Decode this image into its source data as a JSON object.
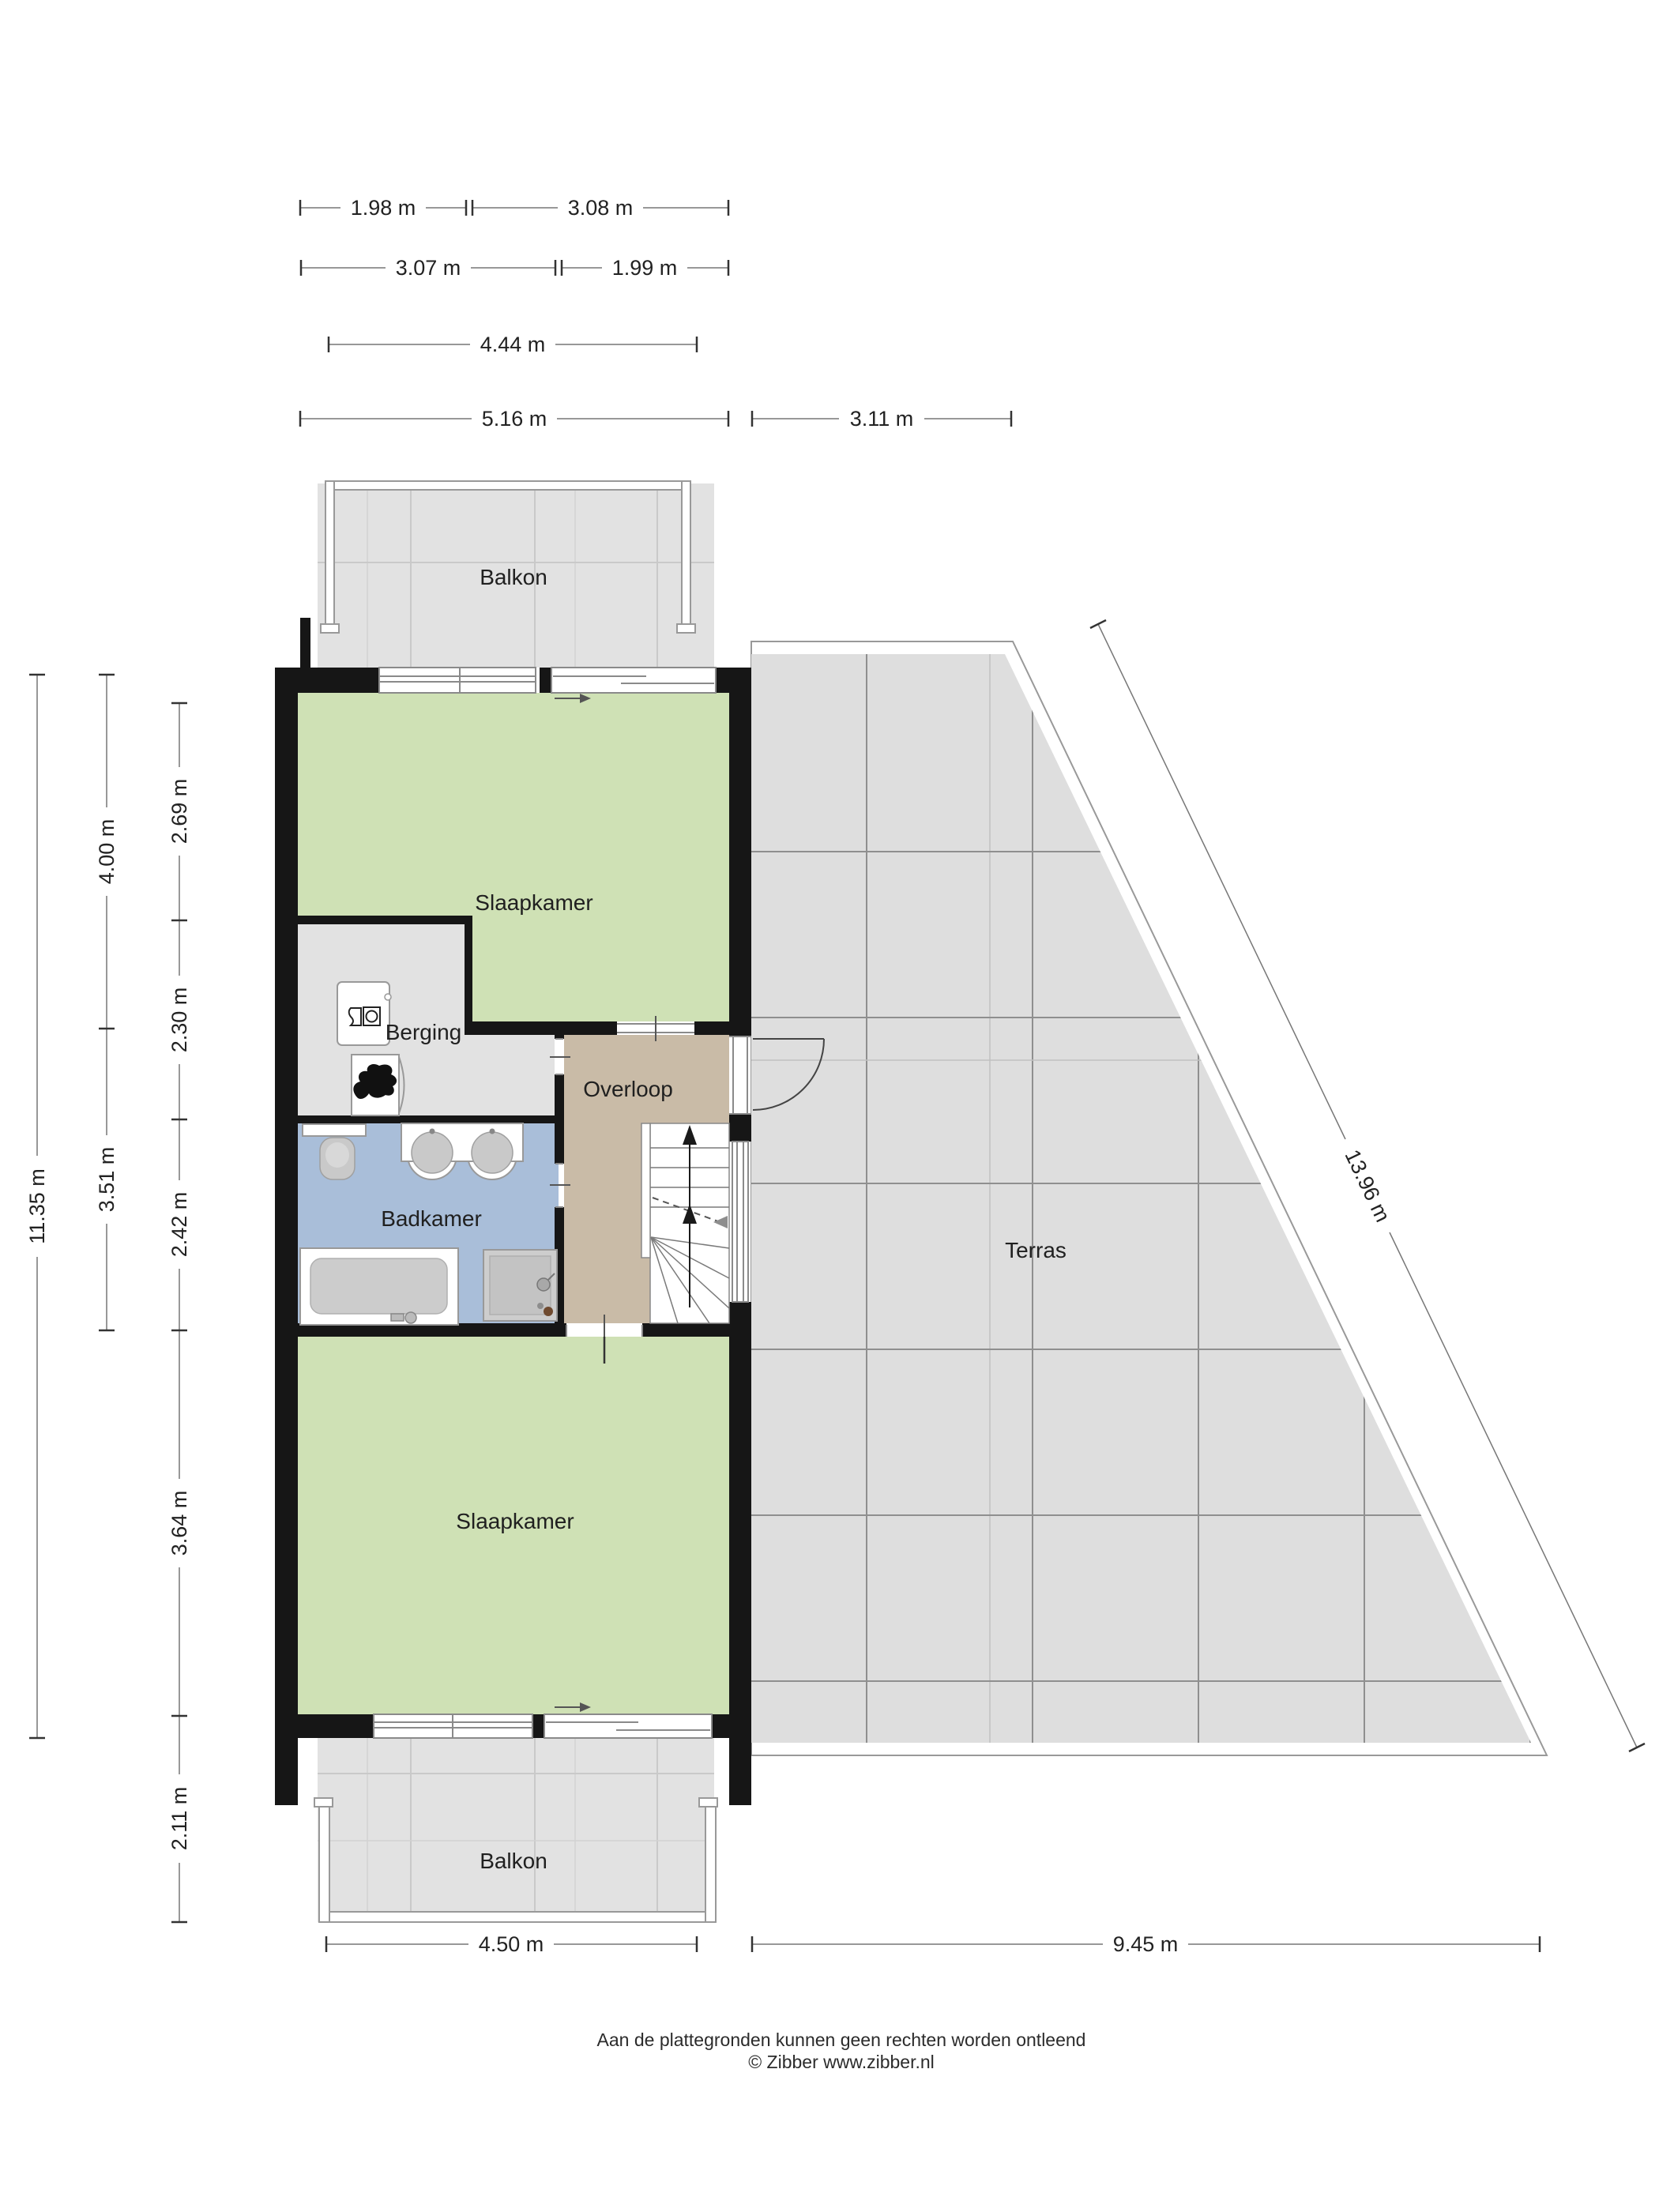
{
  "rooms": {
    "balkon_top": {
      "label": "Balkon"
    },
    "slaapkamer_top": {
      "label": "Slaapkamer"
    },
    "berging": {
      "label": "Berging"
    },
    "overloop": {
      "label": "Overloop"
    },
    "badkamer": {
      "label": "Badkamer"
    },
    "terras": {
      "label": "Terras"
    },
    "slaapkamer_bottom": {
      "label": "Slaapkamer"
    },
    "balkon_bottom": {
      "label": "Balkon"
    }
  },
  "dimensions": {
    "top_row1": {
      "a": "1.98 m",
      "b": "3.08 m"
    },
    "top_row2": {
      "a": "3.07 m",
      "b": "1.99 m"
    },
    "top_row3": {
      "a": "4.44 m"
    },
    "top_row4": {
      "a": "5.16 m",
      "b": "3.11 m"
    },
    "left_col1": {
      "a": "11.35 m"
    },
    "left_col2": {
      "a": "4.00 m",
      "b": "3.51 m"
    },
    "left_col3": {
      "a": "2.69 m",
      "b": "2.30 m",
      "c": "2.42 m",
      "d": "3.64 m",
      "e": "2.11 m"
    },
    "bottom": {
      "a": "4.50 m",
      "b": "9.45 m"
    },
    "diagonal": {
      "a": "13.96 m"
    }
  },
  "footer": {
    "line1": "Aan de plattegronden kunnen geen rechten worden ontleend",
    "line2": "© Zibber www.zibber.nl"
  },
  "colors": {
    "wall": "#161616",
    "bedroom_green": "#cfe1b5",
    "bathroom_blue": "#a9bed9",
    "landing_tan": "#c9bba7",
    "storage_gray": "#e2e2e2",
    "terrace_gray": "#dedede"
  }
}
